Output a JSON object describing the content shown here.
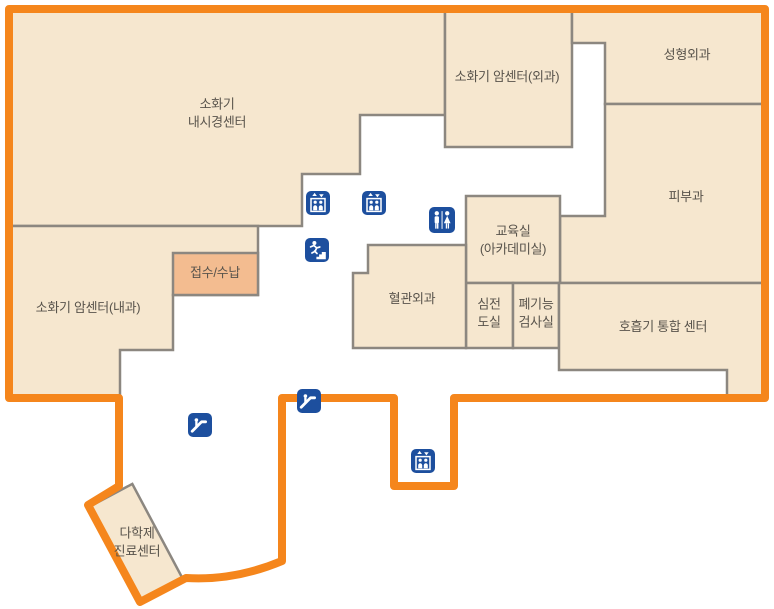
{
  "map": {
    "floor_type": "hospital-floor-plan",
    "colors": {
      "outline_orange": "#F5861C",
      "room_fill": "#F6E7CF",
      "reception_fill": "#F3BC90",
      "wall_gray": "#8C8780",
      "icon_blue": "#1D4F9E",
      "label_text": "#59544C"
    },
    "rooms": [
      {
        "id": "endoscopy-center",
        "label": "소화기\n내시경센터"
      },
      {
        "id": "cancer-center-surgery",
        "label": "소화기 암센터(외과)"
      },
      {
        "id": "plastic-surgery",
        "label": "성형외과"
      },
      {
        "id": "dermatology",
        "label": "피부과"
      },
      {
        "id": "education-room",
        "label": "교육실\n(아카데미실)"
      },
      {
        "id": "vascular-surgery",
        "label": "혈관외과"
      },
      {
        "id": "ecg-room",
        "label": "심전\n도실"
      },
      {
        "id": "pulmonary-test-room",
        "label": "폐기능\n검사실"
      },
      {
        "id": "respiratory-center",
        "label": "호흡기 통합 센터"
      },
      {
        "id": "cancer-center-internal",
        "label": "소화기 암센터(내과)"
      },
      {
        "id": "reception",
        "label": "접수/수납"
      },
      {
        "id": "multidisciplinary-center",
        "label": "다학제\n진료센터"
      }
    ],
    "icons": [
      {
        "name": "elevator-icon"
      },
      {
        "name": "elevator-icon"
      },
      {
        "name": "restroom-icon"
      },
      {
        "name": "stairs-icon"
      },
      {
        "name": "escalator-icon"
      },
      {
        "name": "escalator-icon"
      },
      {
        "name": "elevator-icon"
      }
    ]
  }
}
